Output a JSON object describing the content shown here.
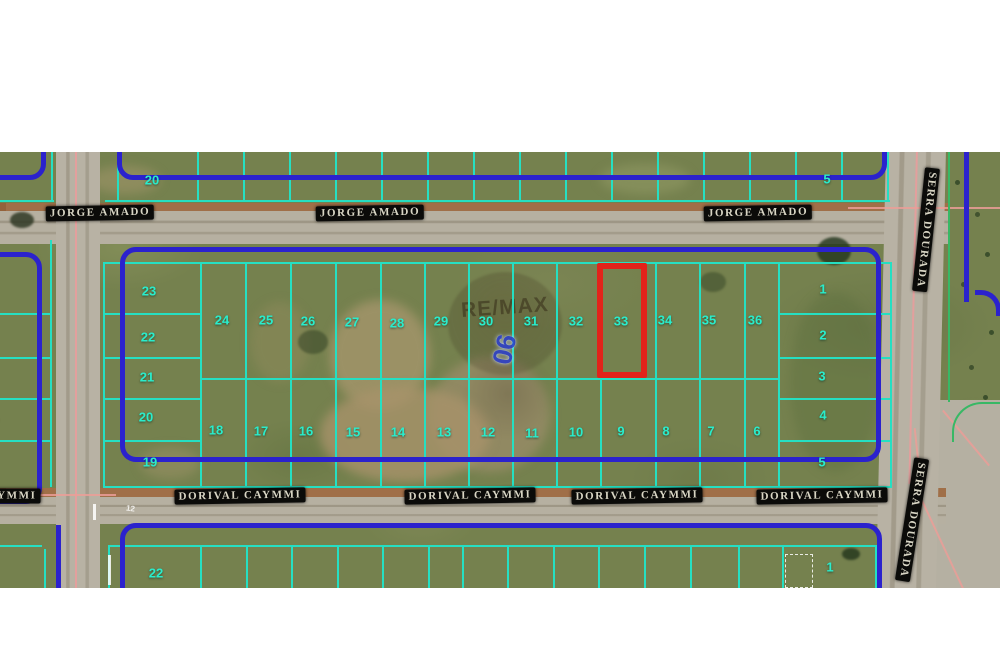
{
  "map": {
    "street_labels": [
      {
        "text": "JORGE AMADO",
        "x": 100,
        "y": 61,
        "rot": -1
      },
      {
        "text": "JORGE AMADO",
        "x": 370,
        "y": 61,
        "rot": -1
      },
      {
        "text": "JORGE AMADO",
        "x": 758,
        "y": 61,
        "rot": -1
      },
      {
        "text": "DORIVAL CAYMMI",
        "x": -25,
        "y": 344,
        "rot": 0
      },
      {
        "text": "DORIVAL CAYMMI",
        "x": 240,
        "y": 344,
        "rot": -1
      },
      {
        "text": "DORIVAL CAYMMI",
        "x": 470,
        "y": 344,
        "rot": -1
      },
      {
        "text": "DORIVAL CAYMMI",
        "x": 637,
        "y": 344,
        "rot": -1
      },
      {
        "text": "DORIVAL CAYMMI",
        "x": 822,
        "y": 344,
        "rot": -1
      },
      {
        "text": "SERRA DOURADA",
        "x": 926,
        "y": 78,
        "rot": 96
      },
      {
        "text": "SERRA DOURADA",
        "x": 912,
        "y": 368,
        "rot": 99
      }
    ],
    "lot_labels": [
      {
        "text": "20",
        "x": 152,
        "y": 28
      },
      {
        "text": "5",
        "x": 827,
        "y": 27
      },
      {
        "text": "23",
        "x": 149,
        "y": 139
      },
      {
        "text": "22",
        "x": 148,
        "y": 185
      },
      {
        "text": "21",
        "x": 147,
        "y": 225
      },
      {
        "text": "20",
        "x": 146,
        "y": 265
      },
      {
        "text": "19",
        "x": 150,
        "y": 310
      },
      {
        "text": "24",
        "x": 222,
        "y": 168
      },
      {
        "text": "25",
        "x": 266,
        "y": 168
      },
      {
        "text": "26",
        "x": 308,
        "y": 169
      },
      {
        "text": "27",
        "x": 352,
        "y": 170
      },
      {
        "text": "28",
        "x": 397,
        "y": 171
      },
      {
        "text": "29",
        "x": 441,
        "y": 169
      },
      {
        "text": "30",
        "x": 486,
        "y": 169
      },
      {
        "text": "31",
        "x": 531,
        "y": 169
      },
      {
        "text": "32",
        "x": 576,
        "y": 169
      },
      {
        "text": "33",
        "x": 621,
        "y": 169
      },
      {
        "text": "34",
        "x": 665,
        "y": 168
      },
      {
        "text": "35",
        "x": 709,
        "y": 168
      },
      {
        "text": "36",
        "x": 755,
        "y": 168
      },
      {
        "text": "18",
        "x": 216,
        "y": 278
      },
      {
        "text": "17",
        "x": 261,
        "y": 279
      },
      {
        "text": "16",
        "x": 306,
        "y": 279
      },
      {
        "text": "15",
        "x": 353,
        "y": 280
      },
      {
        "text": "14",
        "x": 398,
        "y": 280
      },
      {
        "text": "13",
        "x": 444,
        "y": 280
      },
      {
        "text": "12",
        "x": 488,
        "y": 280
      },
      {
        "text": "11",
        "x": 532,
        "y": 281
      },
      {
        "text": "10",
        "x": 576,
        "y": 280
      },
      {
        "text": "9",
        "x": 621,
        "y": 279
      },
      {
        "text": "8",
        "x": 666,
        "y": 279
      },
      {
        "text": "7",
        "x": 711,
        "y": 279
      },
      {
        "text": "6",
        "x": 757,
        "y": 279
      },
      {
        "text": "1",
        "x": 823,
        "y": 137
      },
      {
        "text": "2",
        "x": 823,
        "y": 183
      },
      {
        "text": "3",
        "x": 822,
        "y": 224
      },
      {
        "text": "4",
        "x": 823,
        "y": 263
      },
      {
        "text": "5",
        "x": 822,
        "y": 310
      },
      {
        "text": "22",
        "x": 156,
        "y": 421
      },
      {
        "text": "1",
        "x": 830,
        "y": 415
      },
      {
        "text": "2",
        "x": -6,
        "y": 186
      },
      {
        "text": "3",
        "x": -6,
        "y": 224
      },
      {
        "text": "4",
        "x": -5,
        "y": 265
      },
      {
        "text": "5",
        "x": -6,
        "y": 309
      }
    ],
    "highlight": {
      "lot": "33",
      "x": 597,
      "y": 111,
      "w": 50,
      "h": 115
    },
    "watermark": {
      "brand": "RE/MAX",
      "block_label": "06"
    },
    "ground_mark": {
      "text": "12"
    }
  },
  "colors": {
    "lot_line": "#25dfc2",
    "block_line": "#2b22cd",
    "highlight": "#e2231a",
    "lot_text": "#2aeccb",
    "street_text": "#d8d5c4",
    "street_bg": "#0b0b09",
    "survey_pink": "#eb9e98",
    "grass": "#75814e",
    "road": "#b6b0a1"
  }
}
